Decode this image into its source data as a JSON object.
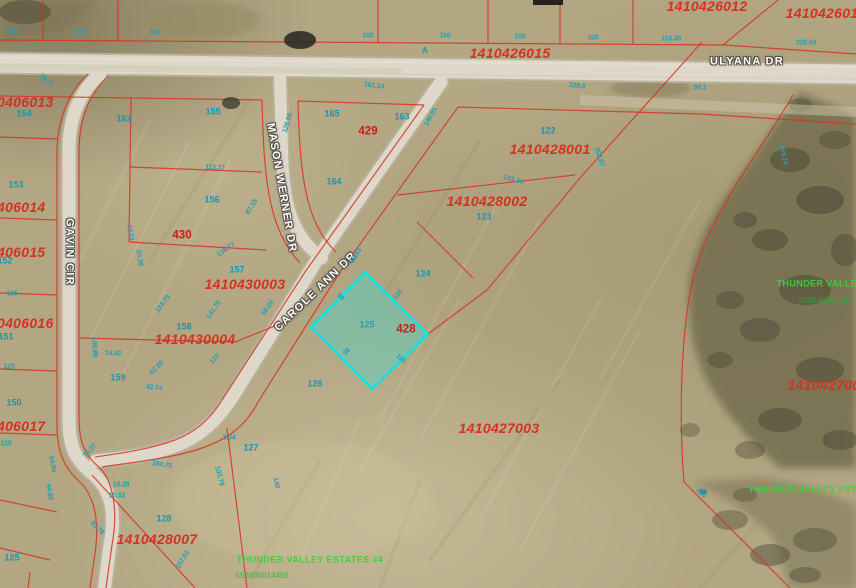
{
  "map": {
    "type": "gis-parcel-aerial-map",
    "colors": {
      "field_base": "#b3a683",
      "road_fill": "#ddd8ca",
      "parcel_line": "#d63222",
      "parcel_id_text": "#d63222",
      "lot_number_text": "#1798ad",
      "subdivision_text": "#37d337",
      "selected_parcel_outline": "#00e6e6",
      "road_label_text": "#fdfdf8"
    },
    "selected_parcel": {
      "lot_number": "125",
      "block_number": "428",
      "outline_color": "#00e6e6"
    },
    "labels": [
      {
        "cls": "pid",
        "name": "parcel-id",
        "text": "1410426012",
        "x": 707,
        "y": 6
      },
      {
        "cls": "pid",
        "name": "parcel-id",
        "text": "141042601",
        "x": 822,
        "y": 13
      },
      {
        "cls": "pid",
        "name": "parcel-id",
        "text": "1410426015",
        "x": 510,
        "y": 53
      },
      {
        "cls": "pid",
        "name": "parcel-id",
        "text": "1410428001",
        "x": 550,
        "y": 149
      },
      {
        "cls": "pid",
        "name": "parcel-id",
        "text": "1410428002",
        "x": 487,
        "y": 201
      },
      {
        "cls": "pid",
        "name": "parcel-id",
        "text": "1410430003",
        "x": 245,
        "y": 284
      },
      {
        "cls": "pid",
        "name": "parcel-id",
        "text": "1410430004",
        "x": 195,
        "y": 339
      },
      {
        "cls": "pid",
        "name": "parcel-id",
        "text": "1410427003",
        "x": 499,
        "y": 428
      },
      {
        "cls": "pid",
        "name": "parcel-id",
        "text": "1410428007",
        "x": 157,
        "y": 539
      },
      {
        "cls": "pid",
        "name": "parcel-id",
        "text": "141042700",
        "x": 824,
        "y": 385
      },
      {
        "cls": "pid",
        "name": "parcel-id",
        "text": "0406013",
        "x": -3,
        "y": 102,
        "anchor": "l"
      },
      {
        "cls": "pid",
        "name": "parcel-id",
        "text": "406014",
        "x": -3,
        "y": 207,
        "anchor": "l"
      },
      {
        "cls": "pid",
        "name": "parcel-id",
        "text": "406015",
        "x": -3,
        "y": 252,
        "anchor": "l"
      },
      {
        "cls": "pid",
        "name": "parcel-id",
        "text": "0406016",
        "x": -3,
        "y": 323,
        "anchor": "l"
      },
      {
        "cls": "pid",
        "name": "parcel-id",
        "text": "406017",
        "x": -3,
        "y": 426,
        "anchor": "l"
      },
      {
        "cls": "blk",
        "name": "block-number",
        "text": "429",
        "x": 368,
        "y": 132
      },
      {
        "cls": "blk",
        "name": "block-number",
        "text": "430",
        "x": 182,
        "y": 236
      },
      {
        "cls": "blk",
        "name": "block-number",
        "text": "428",
        "x": 406,
        "y": 330
      },
      {
        "cls": "road",
        "name": "road-name-ulyana-dr",
        "text": "ULYANA DR",
        "x": 747,
        "y": 62
      },
      {
        "cls": "road",
        "name": "road-name-mason-werner-dr",
        "text": "MASON WERNER DR",
        "x": 281,
        "y": 188,
        "rot": 80
      },
      {
        "cls": "road",
        "name": "road-name-carole-ann-dr",
        "text": "CAROLE ANN DR",
        "x": 316,
        "y": 292,
        "rot": -44
      },
      {
        "cls": "road",
        "name": "road-name-gavin-cir",
        "text": "GAVIN CIR",
        "x": 69,
        "y": 252,
        "rot": 90
      },
      {
        "cls": "lot",
        "name": "lot-number",
        "text": "162",
        "x": 124,
        "y": 119
      },
      {
        "cls": "lot",
        "name": "lot-number",
        "text": "155",
        "x": 213,
        "y": 112
      },
      {
        "cls": "lot",
        "name": "lot-number",
        "text": "165",
        "x": 332,
        "y": 114
      },
      {
        "cls": "lot",
        "name": "lot-number",
        "text": "163",
        "x": 402,
        "y": 117
      },
      {
        "cls": "lot",
        "name": "lot-number",
        "text": "122",
        "x": 548,
        "y": 131
      },
      {
        "cls": "lot",
        "name": "lot-number",
        "text": "164",
        "x": 334,
        "y": 182
      },
      {
        "cls": "lot",
        "name": "lot-number",
        "text": "123",
        "x": 484,
        "y": 217
      },
      {
        "cls": "lot",
        "name": "lot-number",
        "text": "124",
        "x": 423,
        "y": 274
      },
      {
        "cls": "lot",
        "name": "lot-number",
        "text": "157",
        "x": 237,
        "y": 270
      },
      {
        "cls": "lot",
        "name": "lot-number",
        "text": "156",
        "x": 212,
        "y": 200
      },
      {
        "cls": "lot",
        "name": "lot-number",
        "text": "158",
        "x": 184,
        "y": 327
      },
      {
        "cls": "lot",
        "name": "lot-number-selected",
        "text": "125",
        "x": 367,
        "y": 325,
        "op": 0.8
      },
      {
        "cls": "lot",
        "name": "lot-number",
        "text": "126",
        "x": 315,
        "y": 384
      },
      {
        "cls": "lot",
        "name": "lot-number",
        "text": "159",
        "x": 118,
        "y": 378
      },
      {
        "cls": "lot",
        "name": "lot-number",
        "text": "150",
        "x": 14,
        "y": 403
      },
      {
        "cls": "lot",
        "name": "lot-number",
        "text": "153",
        "x": 16,
        "y": 185
      },
      {
        "cls": "lot",
        "name": "lot-number",
        "text": "154",
        "x": 24,
        "y": 114
      },
      {
        "cls": "lot",
        "name": "lot-number",
        "text": "151",
        "x": 6,
        "y": 337
      },
      {
        "cls": "lot",
        "name": "lot-number",
        "text": "152",
        "x": 5,
        "y": 261
      },
      {
        "cls": "lot",
        "name": "lot-number",
        "text": "127",
        "x": 251,
        "y": 448
      },
      {
        "cls": "lot",
        "name": "lot-number",
        "text": "128",
        "x": 164,
        "y": 519
      },
      {
        "cls": "lot",
        "name": "lot-number",
        "text": "125",
        "x": 12,
        "y": 558
      },
      {
        "cls": "mark",
        "name": "road-mark-a",
        "text": "A",
        "x": 425,
        "y": 51
      },
      {
        "cls": "dim",
        "name": "dimension",
        "text": "100",
        "x": 12,
        "y": 32
      },
      {
        "cls": "dim",
        "name": "dimension",
        "text": "100",
        "x": 80,
        "y": 32
      },
      {
        "cls": "dim",
        "name": "dimension",
        "text": "100",
        "x": 155,
        "y": 33
      },
      {
        "cls": "dim",
        "name": "dimension",
        "text": "100",
        "x": 368,
        "y": 36
      },
      {
        "cls": "dim",
        "name": "dimension",
        "text": "100",
        "x": 445,
        "y": 36
      },
      {
        "cls": "dim",
        "name": "dimension",
        "text": "100",
        "x": 520,
        "y": 37
      },
      {
        "cls": "dim",
        "name": "dimension",
        "text": "100",
        "x": 593,
        "y": 38
      },
      {
        "cls": "dim",
        "name": "dimension",
        "text": "118.38",
        "x": 671,
        "y": 39
      },
      {
        "cls": "dim",
        "name": "dimension",
        "text": "229.84",
        "x": 806,
        "y": 43
      },
      {
        "cls": "dim",
        "name": "dimension",
        "text": "78.71",
        "x": 46,
        "y": 81,
        "rot": 40
      },
      {
        "cls": "dim",
        "name": "dimension",
        "text": "161.14",
        "x": 374,
        "y": 86,
        "rot": 8
      },
      {
        "cls": "dim",
        "name": "dimension",
        "text": "228.8",
        "x": 577,
        "y": 86,
        "rot": 5
      },
      {
        "cls": "dim",
        "name": "dimension",
        "text": "54.1",
        "x": 700,
        "y": 88
      },
      {
        "cls": "dim",
        "name": "dimension",
        "text": "112.77",
        "x": 215,
        "y": 168,
        "rot": 3
      },
      {
        "cls": "dim",
        "name": "dimension",
        "text": "126.06",
        "x": 288,
        "y": 123,
        "rot": -73
      },
      {
        "cls": "dim",
        "name": "dimension",
        "text": "140.91",
        "x": 431,
        "y": 117,
        "rot": -62
      },
      {
        "cls": "dim",
        "name": "dimension",
        "text": "64.01",
        "x": 130,
        "y": 233,
        "rot": 80
      },
      {
        "cls": "dim",
        "name": "dimension",
        "text": "87.15",
        "x": 252,
        "y": 207,
        "rot": -60
      },
      {
        "cls": "dim",
        "name": "dimension",
        "text": "68.43",
        "x": 356,
        "y": 256,
        "rot": -57
      },
      {
        "cls": "dim",
        "name": "dimension",
        "text": "143.24",
        "x": 513,
        "y": 180,
        "rot": 15
      },
      {
        "cls": "dim",
        "name": "dimension",
        "text": "262.67",
        "x": 599,
        "y": 157,
        "rot": 72
      },
      {
        "cls": "dim",
        "name": "dimension",
        "text": "565.74",
        "x": 783,
        "y": 155,
        "rot": 78
      },
      {
        "cls": "dim",
        "name": "dimension",
        "text": "74.42",
        "x": 113,
        "y": 354
      },
      {
        "cls": "dim",
        "name": "dimension",
        "text": "108.88",
        "x": 94,
        "y": 347,
        "rot": 85
      },
      {
        "cls": "dim",
        "name": "dimension",
        "text": "76.37",
        "x": 90,
        "y": 451,
        "rot": -48
      },
      {
        "cls": "dim",
        "name": "dimension",
        "text": "138.77",
        "x": 226,
        "y": 250,
        "rot": -35
      },
      {
        "cls": "dim",
        "name": "dimension",
        "text": "141.78",
        "x": 214,
        "y": 310,
        "rot": -55
      },
      {
        "cls": "dim",
        "name": "dimension",
        "text": "124.79",
        "x": 163,
        "y": 304,
        "rot": -52
      },
      {
        "cls": "dim",
        "name": "dimension",
        "text": "110",
        "x": 215,
        "y": 359,
        "rot": -50
      },
      {
        "cls": "dim",
        "name": "dimension",
        "text": "62.85",
        "x": 157,
        "y": 368,
        "rot": -45
      },
      {
        "cls": "dim",
        "name": "dimension",
        "text": "42.74",
        "x": 154,
        "y": 388,
        "rot": 5
      },
      {
        "cls": "dim",
        "name": "dimension",
        "text": "58.04",
        "x": 268,
        "y": 308,
        "rot": -55
      },
      {
        "cls": "dim",
        "name": "dimension",
        "text": "94",
        "x": 340,
        "y": 297,
        "rot": 45
      },
      {
        "cls": "dim",
        "name": "dimension",
        "text": "116",
        "x": 398,
        "y": 295,
        "rot": -45
      },
      {
        "cls": "dim",
        "name": "dimension",
        "text": "98",
        "x": 347,
        "y": 352,
        "rot": -48
      },
      {
        "cls": "dim",
        "name": "dimension",
        "text": "101",
        "x": 401,
        "y": 359,
        "rot": 42
      },
      {
        "cls": "dim",
        "name": "dimension",
        "text": "184.75",
        "x": 162,
        "y": 465,
        "rot": 10
      },
      {
        "cls": "dim",
        "name": "dimension",
        "text": "3.34",
        "x": 229,
        "y": 438
      },
      {
        "cls": "dim",
        "name": "dimension",
        "text": "103.78",
        "x": 219,
        "y": 476,
        "rot": 75
      },
      {
        "cls": "dim",
        "name": "dimension",
        "text": "140",
        "x": 276,
        "y": 483,
        "rot": 75
      },
      {
        "cls": "dim",
        "name": "dimension",
        "text": "18.28",
        "x": 121,
        "y": 485
      },
      {
        "cls": "dim",
        "name": "dimension",
        "text": "15.52",
        "x": 117,
        "y": 496
      },
      {
        "cls": "dim",
        "name": "dimension",
        "text": "64.89",
        "x": 52,
        "y": 464,
        "rot": 80
      },
      {
        "cls": "dim",
        "name": "dimension",
        "text": "94.89",
        "x": 49,
        "y": 492,
        "rot": 80
      },
      {
        "cls": "dim",
        "name": "dimension",
        "text": "93.78",
        "x": 97,
        "y": 528,
        "rot": 45
      },
      {
        "cls": "dim",
        "name": "dimension",
        "text": "157.63",
        "x": 183,
        "y": 560,
        "rot": -57
      },
      {
        "cls": "dim",
        "name": "dimension",
        "text": "20.38",
        "x": 139,
        "y": 258,
        "rot": 80
      },
      {
        "cls": "dim",
        "name": "dimension",
        "text": "125",
        "x": 12,
        "y": 294
      },
      {
        "cls": "dim",
        "name": "dimension",
        "text": "125",
        "x": 9,
        "y": 367
      },
      {
        "cls": "dim",
        "name": "dimension",
        "text": "125",
        "x": 6,
        "y": 444
      },
      {
        "cls": "dim",
        "name": "dimension",
        "text": "256",
        "x": 701,
        "y": 493,
        "rot": 45
      },
      {
        "cls": "grn1",
        "name": "subdivision-name",
        "text": "THUNDER VALLEY",
        "x": 820,
        "y": 284
      },
      {
        "cls": "grn2",
        "name": "subdivision-id",
        "text": "3025-0001280",
        "x": 824,
        "y": 301
      },
      {
        "cls": "grn1",
        "name": "subdivision-name",
        "text": "THUNDER VALLEY ESTATES",
        "x": 815,
        "y": 490
      },
      {
        "cls": "grn1",
        "name": "subdivision-name",
        "text": "THUNDER VALLEY ESTATES #4",
        "x": 310,
        "y": 560
      },
      {
        "cls": "grn2",
        "name": "subdivision-id",
        "text": "552000014455",
        "x": 262,
        "y": 576
      }
    ]
  }
}
